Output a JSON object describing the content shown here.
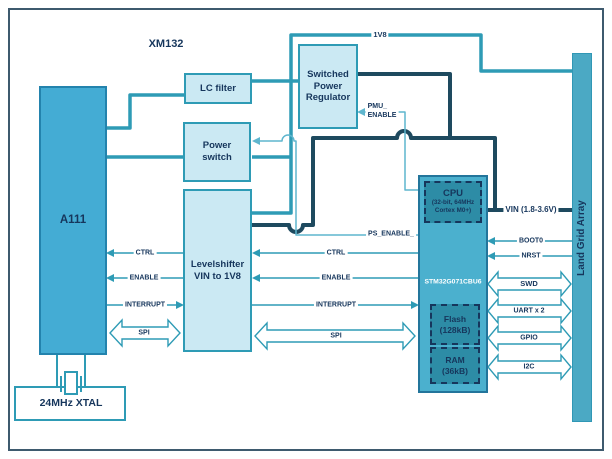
{
  "title": "XM132",
  "blocks": {
    "a111": "A111",
    "lc_filter": "LC filter",
    "power_switch": "Power\nswitch",
    "regulator": "Switched\nPower\nRegulator",
    "levelshifter": "Levelshifter\nVIN to 1V8",
    "mcu_part": "STM32G071CBU6",
    "cpu_title": "CPU",
    "cpu_sub": "(32-bit, 64MHz\nCortex M0+)",
    "flash": "Flash\n(128kB)",
    "ram": "RAM\n(36kB)",
    "lga": "Land Grid Array",
    "xtal": "24MHz XTAL"
  },
  "nets": {
    "v18": "1V8",
    "vin": "VIN (1.8-3.6V)",
    "pmu_enable": "PMU_\nENABLE",
    "ps_enable": "PS_ENABLE_"
  },
  "signals": {
    "ctrl_a111": "CTRL",
    "enable_a111": "ENABLE",
    "interrupt_a111": "INTERRUPT",
    "spi_a111": "SPI",
    "ctrl_mcu": "CTRL",
    "enable_mcu": "ENABLE",
    "interrupt_mcu": "INTERRUPT",
    "spi_mcu": "SPI",
    "boot0": "BOOT0",
    "nrst": "NRST",
    "swd": "SWD",
    "uart": "UART x 2",
    "gpio": "GPIO",
    "i2c": "I2C"
  },
  "colors": {
    "wire_teal": "#2E9BB5",
    "wire_dark": "#1E4A5F",
    "wire_thin": "#5FB6CE",
    "block_light": "#CBE9F3",
    "block_a111": "#44ACD4",
    "block_mcu": "#4BB0CE",
    "block_inner": "#2D8CA6",
    "lga_fill": "#4BA9C4",
    "text_navy": "#16365C",
    "frame": "#3E5A6E"
  }
}
